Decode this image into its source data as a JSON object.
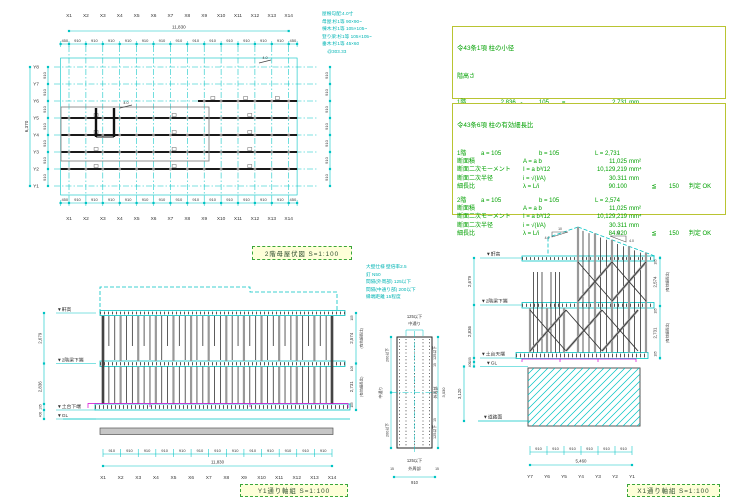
{
  "plan": {
    "title": "2階母屋伏図 S=1:100",
    "x_labels": [
      "X1",
      "X2",
      "X3",
      "X4",
      "X5",
      "X6",
      "X7",
      "X8",
      "X9",
      "X10",
      "X11",
      "X12",
      "X13",
      "X14"
    ],
    "y_labels": [
      "Y8",
      "Y7",
      "Y6",
      "Y5",
      "Y4",
      "Y3",
      "Y2",
      "Y1"
    ],
    "top_total": "11,830",
    "left_total": "6,370",
    "edge_dim": "450",
    "bay_dim": "910",
    "slope_mark": "4.0",
    "notes": [
      "屋根勾配:4.0寸",
      "母屋:杉1等 90×90~",
      "棟木:杉1等 105×105~",
      "登り梁:杉1等 105×105~",
      "垂木:杉1等 45×60",
      "    @303.33"
    ]
  },
  "calc1": {
    "title": "令43条1項 柱の小径",
    "subtitle": "階高さ",
    "height_rows": [
      [
        "1階",
        "2,836",
        "-",
        "105",
        "=",
        "2,731",
        "mm",
        "",
        "",
        ""
      ],
      [
        "2階",
        "2,679",
        "-",
        "105",
        "=",
        "2,574",
        "mm",
        "",
        "",
        ""
      ]
    ],
    "check_rows": [
      [
        "1階",
        "2,731",
        "÷",
        "28",
        "=",
        "97.536",
        "mm",
        "≦",
        "105",
        "判定 OK"
      ],
      [
        "2階",
        "2,469",
        "÷",
        "30",
        "=",
        "82.300",
        "mm",
        "≦",
        "105",
        "判定 OK"
      ]
    ]
  },
  "calc2": {
    "title": "令43条6項 柱の有効細長比",
    "sections": [
      {
        "floor": "1階",
        "a": "a = 105",
        "b": "b = 105",
        "L": "L = 2,731",
        "rows": [
          [
            "断面積",
            "A = a b",
            "11,025",
            "mm²",
            "",
            "",
            ""
          ],
          [
            "断面二次モーメント",
            "I = a b³/12",
            "10,129,219",
            "mm⁴",
            "",
            "",
            ""
          ],
          [
            "断面二次半径",
            "i = √(I/A)",
            "30.311",
            "mm",
            "",
            "",
            ""
          ],
          [
            "細長比",
            "λ = L/i",
            "90.100",
            "",
            "≦",
            "150",
            "判定 OK"
          ]
        ]
      },
      {
        "floor": "2階",
        "a": "a = 105",
        "b": "b = 105",
        "L": "L = 2,574",
        "rows": [
          [
            "断面積",
            "A = a b",
            "11,025",
            "mm²",
            "",
            "",
            ""
          ],
          [
            "断面二次モーメント",
            "I = a b³/12",
            "10,129,219",
            "mm⁴",
            "",
            "",
            ""
          ],
          [
            "断面二次半径",
            "i = √(I/A)",
            "30.311",
            "mm",
            "",
            "",
            ""
          ],
          [
            "細長比",
            "λ = L/i",
            "84.920",
            "",
            "≦",
            "150",
            "判定 OK"
          ]
        ]
      }
    ]
  },
  "y1_view": {
    "title": "Y1通り軸組 S=1:100",
    "levels": [
      "▼軒高",
      "▼2階梁下端",
      "▼土台下端",
      "▼GL"
    ],
    "left_dims": [
      "2,679",
      "2,836",
      "105",
      "400"
    ],
    "right_dims": [
      {
        "span": "2,574",
        "note": "(有効細長比)"
      },
      {
        "span": "2,731",
        "note": "(有効細長比)"
      }
    ],
    "right_small": "105",
    "bay_dim": "910",
    "bottom_total": "11,830",
    "x_labels": [
      "X1",
      "X2",
      "X3",
      "X4",
      "X5",
      "X6",
      "X7",
      "X8",
      "X9",
      "X10",
      "X11",
      "X12",
      "X13",
      "X14"
    ]
  },
  "x1_view": {
    "title": "X1通り軸組 S=1:100",
    "levels": [
      "▼軒高",
      "▼2階梁下端",
      "▼土台天端",
      "▼GL",
      "▼道路面"
    ],
    "left_dims": [
      "2,679",
      "2,836",
      "105",
      "400",
      "3,120"
    ],
    "right_dims": [
      {
        "span": "2,574",
        "note": "(有効細長比)"
      },
      {
        "span": "2,731",
        "note": "(有効細長比)"
      }
    ],
    "right_small": "105",
    "slope_run": "10",
    "slope_rise": "4.0",
    "bay_dim": "910",
    "bottom_total": "5,460",
    "y_labels": [
      "Y7",
      "Y6",
      "Y5",
      "Y4",
      "Y3",
      "Y2",
      "Y1"
    ]
  },
  "panel": {
    "notes": [
      "大壁仕様 壁倍率2.5",
      "釘 N50",
      "間隔(外周部) 125以下",
      "間隔(中通り部) 200以下",
      "縁端距離 15程度"
    ],
    "top_dim": "125以下",
    "top_label": "中通り",
    "left_top_dim": "200以下",
    "left_mid_label": "中通り",
    "left_bottom_dim": "200以下",
    "right_top_dim": "125以下",
    "right_edge": "15",
    "right_mid_label": "外周部",
    "right_span": "3,030",
    "bottom_dim": "125以下",
    "bottom_label": "外周部",
    "bottom_edge": "15",
    "bottom_width": "910"
  },
  "colors": {
    "cyan": "#00c4c4",
    "green": "#00a000",
    "magenta": "#d400d4",
    "title_bg": "#feffd8",
    "calc_border": "#b9c432"
  }
}
